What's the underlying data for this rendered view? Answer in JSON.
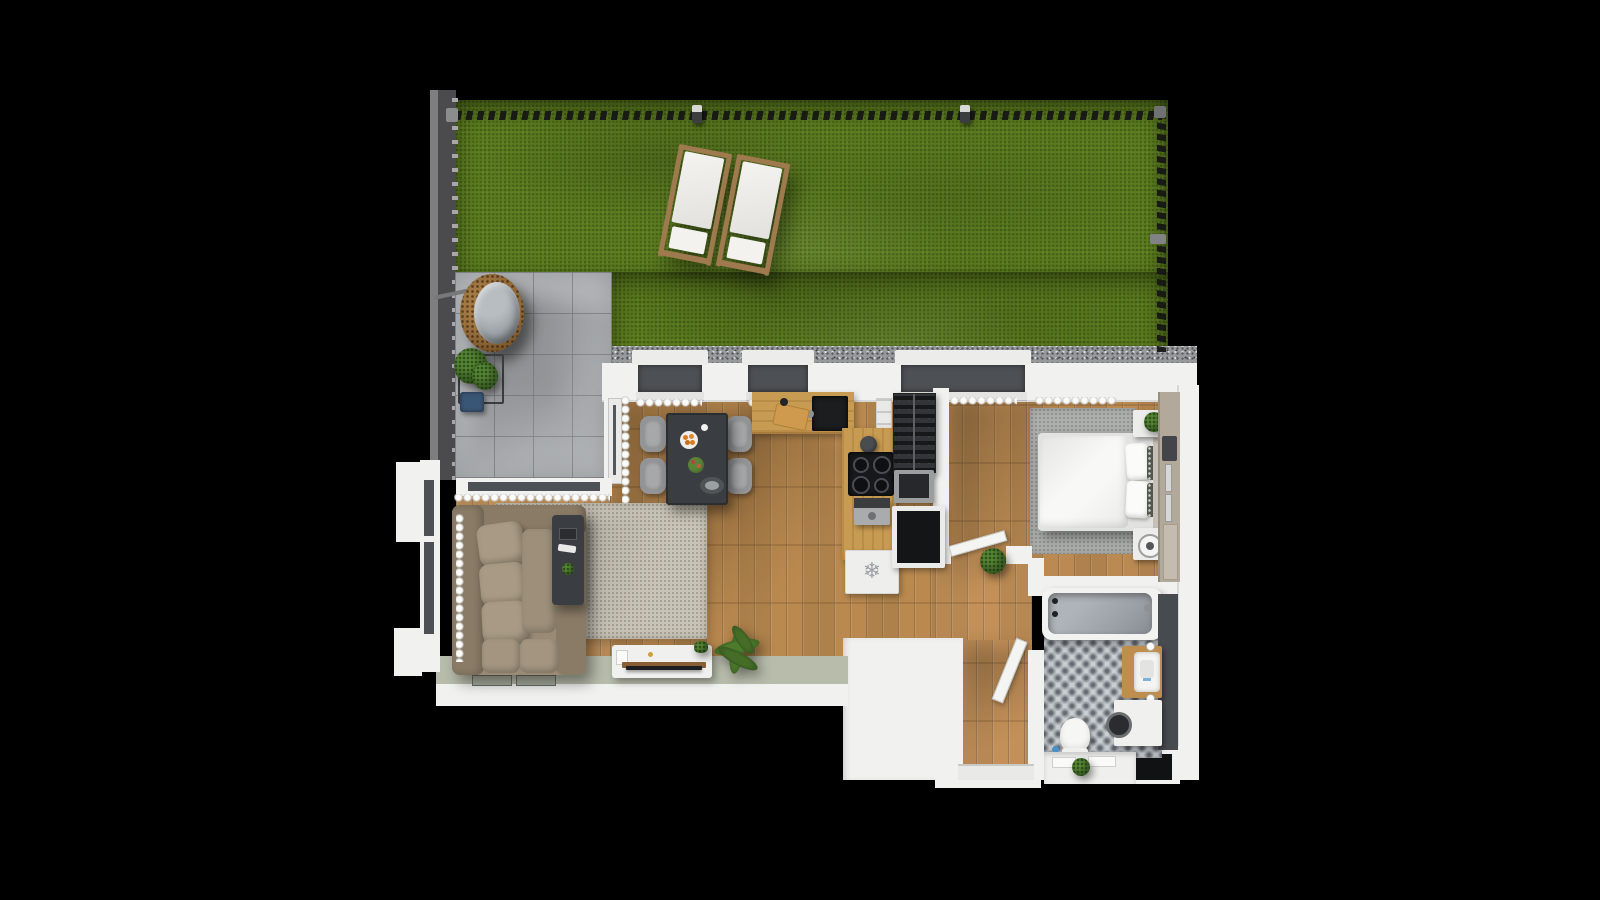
{
  "scene": {
    "type": "3d-floor-plan-top-down-render",
    "background": "#000000"
  },
  "icons": {
    "freezer_snowflake": "❄"
  },
  "palette": {
    "bg": "#000000",
    "grass": "#5b7b1e",
    "gravel": "#97999b",
    "patio": "#b7babc",
    "wall": "#f1f1ef",
    "wallShade": "#d9d9d7",
    "sage": "#b8bcab",
    "glass": "#4d5054",
    "woodMain": "#b9894f",
    "woodLight": "#c2935c",
    "woodBedroom": "#ba8a52",
    "counterWood": "#c79b52",
    "sofa": "#998a75",
    "sofaDark": "#8a7b66",
    "cushion": "#a89a84",
    "rugLiving": "#c9c4b7",
    "rugBedroom": "#aeb0af",
    "tableDark": "#3a3e42",
    "chairGray": "#939496",
    "applianceDark": "#1b1d1f",
    "fridgeWhite": "#eeeeec",
    "duvet": "#f8f8f6",
    "wardrobe": "#b2a99b",
    "tubInner": "#9aa0a6",
    "accentWall": "#474b4f",
    "rattan": "#8d6637",
    "chairCushionGray": "#9aa0a5",
    "planterNavy": "#3a5676",
    "orange": "#d97b1e",
    "plantGreen": "#3f6327",
    "loungerWood": "#9f7a4f",
    "loungerFabric": "#f0efec"
  },
  "garden": {
    "elements": [
      "lawn",
      "perimeter-fence",
      "boundary-wall",
      "garden-lamp",
      "sun-lounger",
      "sun-lounger",
      "gravel-drainage-strip"
    ]
  },
  "terrace": {
    "elements": [
      "concrete-tile-floor",
      "hanging-egg-chair",
      "planter-box",
      "climbing-plant",
      "seat-cushion"
    ]
  },
  "rooms": {
    "living_room": {
      "furniture": [
        "corner-sofa",
        "coffee-table",
        "area-rug",
        "tv-sideboard",
        "tv",
        "palm-plant",
        "curtains",
        "window"
      ]
    },
    "dining_area": {
      "furniture": [
        "dining-table",
        "dining-chair",
        "dining-chair",
        "dining-chair",
        "dining-chair",
        "fruit-plate",
        "flower-vase",
        "serving-tray"
      ]
    },
    "kitchen": {
      "furniture": [
        "countertop",
        "sink",
        "cutting-board",
        "induction-cooktop",
        "kettle",
        "coffee-machine",
        "wine-rack",
        "oven",
        "fridge-freezer",
        "wall-cabinets"
      ]
    },
    "bedroom": {
      "furniture": [
        "double-bed",
        "pillows",
        "nightstand",
        "nightstand",
        "area-rug",
        "wardrobe",
        "potted-plant",
        "speaker",
        "curtains"
      ]
    },
    "bathroom": {
      "furniture": [
        "bathtub",
        "toilet",
        "vanity-with-sink",
        "washing-machine",
        "patterned-tile-floor",
        "accent-wall",
        "potted-plant"
      ]
    },
    "hallway": {
      "furniture": [
        "entrance-door",
        "interior-door",
        "interior-door",
        "potted-plant"
      ]
    }
  }
}
